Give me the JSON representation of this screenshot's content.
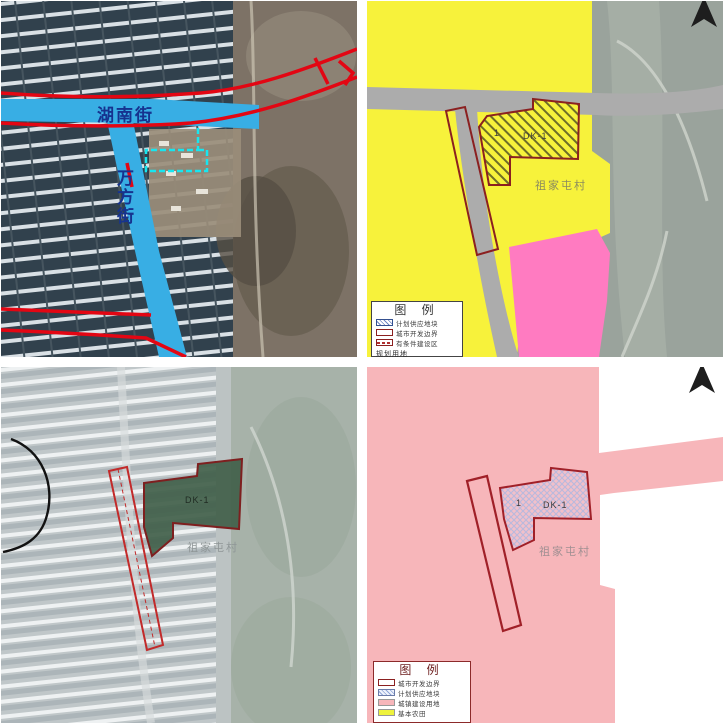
{
  "document": {
    "type": "land-parcel planning map sheet, 2x2 quadrants",
    "north_arrow_icon": "north-arrow-icon"
  },
  "colors": {
    "road_blue": "#38AEE4",
    "boundary_red": "#E30613",
    "cyan_parcel_outline": "#17E6F0",
    "plan_yellow": "#F7F23B",
    "plan_pink": "#FF7BC1",
    "supply_pink": "#F7B6BA",
    "road_gray": "#ACACAC",
    "parcel_green": "#41604A",
    "parcel_outline_dark_red": "#8B2020",
    "hatch_lavender": "#B9B9DD",
    "street_label_blue": "#16338F"
  },
  "quadrants": {
    "top_left": {
      "kind": "satellite with highlighted roads",
      "street_horizontal": "湖南街",
      "street_vertical": "万方街"
    },
    "top_right": {
      "kind": "land-use planning map",
      "parcel_no": "1",
      "parcel_code": "DK-1",
      "village": "祖家屯村",
      "legend": {
        "title": "图 例",
        "items": [
          {
            "swatch": "hatch-blue",
            "label": "计划供应地块"
          },
          {
            "swatch": "red-outline",
            "label": "城市开发边界"
          },
          {
            "swatch": "red-dashed",
            "label": "有条件建设区"
          }
        ],
        "footer": "规划用地"
      }
    },
    "bottom_left": {
      "kind": "faded satellite with parcel boundary",
      "parcel_code": "DK-1",
      "village": "祖家屯村"
    },
    "bottom_right": {
      "kind": "supply plan map",
      "parcel_no": "1",
      "parcel_code": "DK-1",
      "village": "祖家屯村",
      "legend": {
        "title": "图 例",
        "items": [
          {
            "swatch": "red-outline",
            "label": "城市开发边界"
          },
          {
            "swatch": "crosshatch",
            "label": "计划供应地块"
          },
          {
            "swatch": "pink",
            "label": "城镇建设用地"
          },
          {
            "swatch": "yellow",
            "label": "基本农田"
          }
        ]
      }
    }
  }
}
